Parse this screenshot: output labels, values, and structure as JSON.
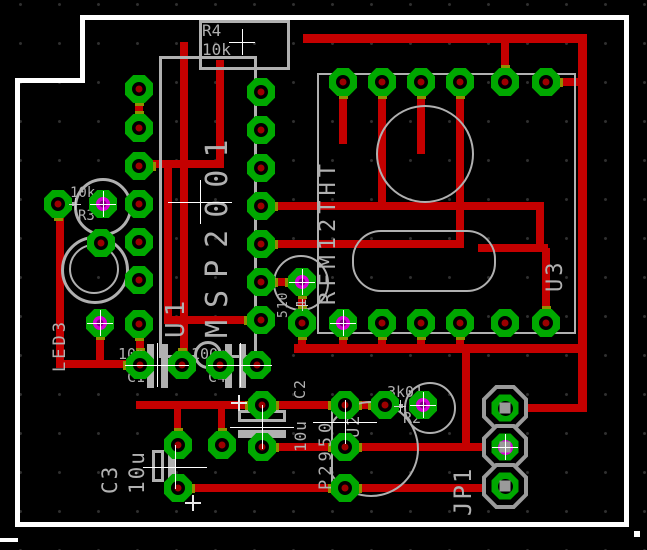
{
  "app": {
    "view": "pcb-layout-canvas",
    "description": "EAGLE-style printed circuit board layout, top copper view"
  },
  "colors": {
    "background": "#000000",
    "trace": "#c40000",
    "pad_ring": "#00a800",
    "pad_hole": "#000000",
    "pad_center": "#9c0000",
    "silkscreen": "#b0b0b0",
    "board_outline": "#ffffff",
    "highlight": "#d800d8",
    "highlight_dark": "#7a007a",
    "pad_trace_overlap": "#8f8f00",
    "grid_dot": "#303030",
    "jp_pad_gray": "#9a9a9a"
  },
  "components": [
    {
      "refdes": "U1",
      "value": "MSP2001",
      "type": "dip-ic"
    },
    {
      "refdes": "U2",
      "value": "P2950",
      "type": "to92-transistor"
    },
    {
      "refdes": "U3",
      "value": "RFM12THT",
      "type": "rf-module"
    },
    {
      "refdes": "R1",
      "value": "510",
      "type": "resistor"
    },
    {
      "refdes": "R2",
      "value": "3k01",
      "type": "resistor"
    },
    {
      "refdes": "R3",
      "value": "10k",
      "type": "resistor"
    },
    {
      "refdes": "R4",
      "value": "10k",
      "type": "resistor"
    },
    {
      "refdes": "C1",
      "value": "10n",
      "type": "capacitor"
    },
    {
      "refdes": "C2",
      "value": "10u",
      "type": "electrolytic-capacitor"
    },
    {
      "refdes": "C3",
      "value": "10u",
      "type": "electrolytic-capacitor"
    },
    {
      "refdes": "C4",
      "value": "100n",
      "type": "capacitor"
    },
    {
      "refdes": "LED3",
      "value": "",
      "type": "led"
    },
    {
      "refdes": "JP1",
      "value": "",
      "type": "pin-header-3"
    }
  ],
  "labels": [
    {
      "text": "R4",
      "x": 202,
      "y": 23,
      "fs": 16,
      "rot": "h",
      "ls": 0
    },
    {
      "text": "10k",
      "x": 202,
      "y": 42,
      "fs": 16,
      "rot": "h",
      "ls": 0
    },
    {
      "text": "10k",
      "x": 70,
      "y": 186,
      "fs": 14,
      "rot": "h",
      "ls": 0
    },
    {
      "text": "R3",
      "x": 78,
      "y": 209,
      "fs": 14,
      "rot": "h",
      "ls": 0
    },
    {
      "text": "10n",
      "x": 118,
      "y": 347,
      "fs": 15,
      "rot": "h",
      "ls": 0
    },
    {
      "text": "C1",
      "x": 127,
      "y": 370,
      "fs": 15,
      "rot": "h",
      "ls": 0
    },
    {
      "text": "100n",
      "x": 191,
      "y": 347,
      "fs": 15,
      "rot": "h",
      "ls": 0
    },
    {
      "text": "C4",
      "x": 208,
      "y": 370,
      "fs": 15,
      "rot": "h",
      "ls": 0
    },
    {
      "text": "3k01",
      "x": 387,
      "y": 385,
      "fs": 15,
      "rot": "h",
      "ls": 0
    },
    {
      "text": "R2",
      "x": 403,
      "y": 411,
      "fs": 15,
      "rot": "h",
      "ls": 0
    },
    {
      "text": "U1",
      "x": 163,
      "y": 338,
      "fs": 26,
      "rot": "v",
      "ls": 6
    },
    {
      "text": "MSP2001",
      "x": 203,
      "y": 338,
      "fs": 30,
      "rot": "v",
      "ls": 12
    },
    {
      "text": "RFM12THT",
      "x": 318,
      "y": 305,
      "fs": 22,
      "rot": "v",
      "ls": 5
    },
    {
      "text": "U3",
      "x": 545,
      "y": 292,
      "fs": 22,
      "rot": "v",
      "ls": 3
    },
    {
      "text": "LED3",
      "x": 52,
      "y": 372,
      "fs": 17,
      "rot": "v",
      "ls": 3
    },
    {
      "text": "510",
      "x": 277,
      "y": 318,
      "fs": 13,
      "rot": "v",
      "ls": 1
    },
    {
      "text": "R1",
      "x": 296,
      "y": 316,
      "fs": 13,
      "rot": "v",
      "ls": 1
    },
    {
      "text": "C2",
      "x": 293,
      "y": 399,
      "fs": 15,
      "rot": "v",
      "ls": 1
    },
    {
      "text": "10u",
      "x": 293,
      "y": 452,
      "fs": 16,
      "rot": "v",
      "ls": 1
    },
    {
      "text": "C3",
      "x": 100,
      "y": 494,
      "fs": 21,
      "rot": "v",
      "ls": 2
    },
    {
      "text": "10u",
      "x": 127,
      "y": 494,
      "fs": 21,
      "rot": "v",
      "ls": 2
    },
    {
      "text": "P2950",
      "x": 318,
      "y": 490,
      "fs": 17,
      "rot": "v",
      "ls": 4
    },
    {
      "text": "U2",
      "x": 346,
      "y": 438,
      "fs": 17,
      "rot": "v",
      "ls": 2
    },
    {
      "text": "JP1",
      "x": 451,
      "y": 516,
      "fs": 24,
      "rot": "v",
      "ls": 2
    }
  ],
  "board_outline": {
    "segments": [
      [
        80,
        15,
        549,
        5
      ],
      [
        624,
        15,
        5,
        512
      ],
      [
        15,
        522,
        614,
        5
      ],
      [
        15,
        78,
        5,
        449
      ],
      [
        15,
        78,
        70,
        5
      ],
      [
        80,
        15,
        5,
        68
      ],
      [
        0,
        538,
        18,
        4
      ],
      [
        634,
        531,
        6,
        6
      ]
    ]
  },
  "traces": [
    [
      303,
      34,
      280,
      9
    ],
    [
      578,
      34,
      9,
      378
    ],
    [
      501,
      38,
      8,
      46
    ],
    [
      546,
      78,
      40,
      8
    ],
    [
      180,
      42,
      8,
      327
    ],
    [
      216,
      60,
      8,
      108
    ],
    [
      136,
      160,
      88,
      8
    ],
    [
      164,
      164,
      8,
      160
    ],
    [
      164,
      316,
      100,
      8
    ],
    [
      339,
      82,
      8,
      62
    ],
    [
      378,
      82,
      8,
      128
    ],
    [
      417,
      82,
      8,
      72
    ],
    [
      456,
      82,
      8,
      166
    ],
    [
      257,
      202,
      287,
      8
    ],
    [
      257,
      240,
      207,
      8
    ],
    [
      536,
      206,
      8,
      46
    ],
    [
      478,
      244,
      70,
      8
    ],
    [
      542,
      248,
      8,
      79
    ],
    [
      257,
      278,
      49,
      8
    ],
    [
      298,
      282,
      8,
      70
    ],
    [
      294,
      344,
      292,
      9
    ],
    [
      339,
      323,
      8,
      29
    ],
    [
      378,
      323,
      8,
      29
    ],
    [
      417,
      323,
      8,
      29
    ],
    [
      456,
      323,
      8,
      29
    ],
    [
      56,
      200,
      8,
      167
    ],
    [
      56,
      360,
      89,
      8
    ],
    [
      96,
      321,
      8,
      47
    ],
    [
      136,
      324,
      8,
      44
    ],
    [
      136,
      401,
      253,
      8
    ],
    [
      218,
      405,
      7,
      42
    ],
    [
      174,
      405,
      7,
      42
    ],
    [
      258,
      443,
      251,
      8
    ],
    [
      174,
      484,
      335,
      8
    ],
    [
      462,
      348,
      8,
      103
    ],
    [
      501,
      404,
      84,
      8
    ],
    [
      135,
      85,
      8,
      46
    ]
  ],
  "pads": [
    {
      "x": 139,
      "y": 89,
      "s": "b",
      "t": "g"
    },
    {
      "x": 139,
      "y": 128,
      "s": "t",
      "t": "g"
    },
    {
      "x": 139,
      "y": 166,
      "s": "r",
      "t": "g"
    },
    {
      "x": 139,
      "y": 204,
      "s": "",
      "t": "g"
    },
    {
      "x": 139,
      "y": 242,
      "s": "",
      "t": "g"
    },
    {
      "x": 139,
      "y": 280,
      "s": "",
      "t": "g"
    },
    {
      "x": 139,
      "y": 324,
      "s": "b",
      "t": "g"
    },
    {
      "x": 58,
      "y": 204,
      "s": "b",
      "t": "g"
    },
    {
      "x": 103,
      "y": 204,
      "s": "",
      "t": "m"
    },
    {
      "x": 101,
      "y": 243,
      "s": "",
      "t": "g"
    },
    {
      "x": 100,
      "y": 323,
      "s": "b",
      "t": "m"
    },
    {
      "x": 261,
      "y": 92,
      "s": "",
      "t": "g"
    },
    {
      "x": 261,
      "y": 130,
      "s": "",
      "t": "g"
    },
    {
      "x": 261,
      "y": 168,
      "s": "",
      "t": "g"
    },
    {
      "x": 261,
      "y": 206,
      "s": "r",
      "t": "g"
    },
    {
      "x": 261,
      "y": 244,
      "s": "r",
      "t": "g"
    },
    {
      "x": 261,
      "y": 282,
      "s": "r",
      "t": "g"
    },
    {
      "x": 261,
      "y": 320,
      "s": "l",
      "t": "g"
    },
    {
      "x": 140,
      "y": 365,
      "s": "lt",
      "t": "g"
    },
    {
      "x": 182,
      "y": 365,
      "s": "t",
      "t": "g"
    },
    {
      "x": 220,
      "y": 365,
      "s": "",
      "t": "g"
    },
    {
      "x": 257,
      "y": 365,
      "s": "",
      "t": "g"
    },
    {
      "x": 222,
      "y": 445,
      "s": "t",
      "t": "g"
    },
    {
      "x": 262,
      "y": 405,
      "s": "lr",
      "t": "g"
    },
    {
      "x": 262,
      "y": 447,
      "s": "r",
      "t": "g"
    },
    {
      "x": 178,
      "y": 445,
      "s": "t",
      "t": "g"
    },
    {
      "x": 178,
      "y": 488,
      "s": "r",
      "t": "g"
    },
    {
      "x": 345,
      "y": 405,
      "s": "lr",
      "t": "g"
    },
    {
      "x": 345,
      "y": 447,
      "s": "lr",
      "t": "g"
    },
    {
      "x": 345,
      "y": 488,
      "s": "lr",
      "t": "g"
    },
    {
      "x": 385,
      "y": 405,
      "s": "l",
      "t": "g"
    },
    {
      "x": 423,
      "y": 405,
      "s": "",
      "t": "m"
    },
    {
      "x": 302,
      "y": 282,
      "s": "lb",
      "t": "m"
    },
    {
      "x": 302,
      "y": 323,
      "s": "tb",
      "t": "g"
    },
    {
      "x": 343,
      "y": 82,
      "s": "b",
      "t": "g"
    },
    {
      "x": 382,
      "y": 82,
      "s": "b",
      "t": "g"
    },
    {
      "x": 421,
      "y": 82,
      "s": "b",
      "t": "g"
    },
    {
      "x": 460,
      "y": 82,
      "s": "b",
      "t": "g"
    },
    {
      "x": 505,
      "y": 82,
      "s": "t",
      "t": "g"
    },
    {
      "x": 546,
      "y": 82,
      "s": "r",
      "t": "g"
    },
    {
      "x": 343,
      "y": 323,
      "s": "b",
      "t": "m"
    },
    {
      "x": 382,
      "y": 323,
      "s": "b",
      "t": "g"
    },
    {
      "x": 421,
      "y": 323,
      "s": "b",
      "t": "g"
    },
    {
      "x": 460,
      "y": 323,
      "s": "b",
      "t": "g"
    },
    {
      "x": 505,
      "y": 323,
      "s": "",
      "t": "g"
    },
    {
      "x": 546,
      "y": 323,
      "s": "t",
      "t": "g"
    },
    {
      "x": 505,
      "y": 408,
      "s": "r",
      "t": "j"
    },
    {
      "x": 505,
      "y": 447,
      "s": "l",
      "t": "jm"
    },
    {
      "x": 505,
      "y": 486,
      "s": "l",
      "t": "j"
    }
  ],
  "silk_shapes": [
    {
      "kind": "rect",
      "x": 199,
      "y": 20,
      "w": 85,
      "h": 44,
      "bw": 3
    },
    {
      "kind": "rect",
      "x": 159,
      "y": 56,
      "w": 92,
      "h": 296,
      "bw": 3
    },
    {
      "kind": "rect",
      "x": 317,
      "y": 73,
      "w": 255,
      "h": 257,
      "bw": 2
    },
    {
      "kind": "circle",
      "cx": 423,
      "cy": 152,
      "r": 47,
      "bw": 2
    },
    {
      "kind": "circle",
      "cx": 100,
      "cy": 204,
      "r": 26,
      "bw": 3
    },
    {
      "kind": "circle",
      "cx": 92,
      "cy": 267,
      "r": 31,
      "bw": 3
    },
    {
      "kind": "circle",
      "cx": 92,
      "cy": 267,
      "r": 23,
      "bw": 2
    },
    {
      "kind": "circle",
      "cx": 299,
      "cy": 281,
      "r": 26,
      "bw": 2
    },
    {
      "kind": "circle",
      "cx": 428,
      "cy": 406,
      "r": 24,
      "bw": 2
    },
    {
      "kind": "stadium",
      "x": 352,
      "y": 230,
      "w": 140,
      "h": 58,
      "bw": 2
    },
    {
      "kind": "u2circle",
      "cx": 369,
      "cy": 447,
      "r": 46,
      "chord": 331,
      "bw": 2
    },
    {
      "kind": "line",
      "x": 58,
      "y": 202,
      "w": 18,
      "h": 4
    },
    {
      "kind": "line",
      "x": 389,
      "y": 404,
      "w": 14,
      "h": 4
    },
    {
      "kind": "notch",
      "cx": 205,
      "cy": 352,
      "r": 11
    },
    {
      "kind": "bar",
      "x": 147,
      "y": 344,
      "w": 7,
      "h": 44
    },
    {
      "kind": "bar",
      "x": 161,
      "y": 344,
      "w": 7,
      "h": 44
    },
    {
      "kind": "bar",
      "x": 225,
      "y": 344,
      "w": 7,
      "h": 44
    },
    {
      "kind": "bar",
      "x": 239,
      "y": 344,
      "w": 7,
      "h": 44
    },
    {
      "kind": "hbar",
      "x": 238,
      "y": 410,
      "w": 48,
      "h": 12
    },
    {
      "kind": "bar",
      "x": 238,
      "y": 430,
      "w": 48,
      "h": 8
    },
    {
      "kind": "hbar",
      "x": 152,
      "y": 450,
      "w": 12,
      "h": 32
    },
    {
      "kind": "bar",
      "x": 168,
      "y": 450,
      "w": 7,
      "h": 32
    },
    {
      "kind": "plus",
      "x": 239,
      "y": 403
    },
    {
      "kind": "plus",
      "x": 193,
      "y": 503
    }
  ],
  "crosshairs": [
    {
      "x": 242,
      "y": 42,
      "t": "w"
    },
    {
      "x": 200,
      "y": 202,
      "t": "W"
    },
    {
      "x": 103,
      "y": 204,
      "t": "w"
    },
    {
      "x": 75,
      "y": 204,
      "t": "s"
    },
    {
      "x": 100,
      "y": 323,
      "t": "w"
    },
    {
      "x": 157,
      "y": 365,
      "t": "W"
    },
    {
      "x": 240,
      "y": 365,
      "t": "W"
    },
    {
      "x": 262,
      "y": 427,
      "t": "W"
    },
    {
      "x": 175,
      "y": 467,
      "t": "W"
    },
    {
      "x": 345,
      "y": 422,
      "t": "W"
    },
    {
      "x": 302,
      "y": 282,
      "t": "w"
    },
    {
      "x": 302,
      "y": 305,
      "t": "s"
    },
    {
      "x": 400,
      "y": 406,
      "t": "s"
    },
    {
      "x": 423,
      "y": 405,
      "t": "w"
    },
    {
      "x": 343,
      "y": 323,
      "t": "w"
    },
    {
      "x": 505,
      "y": 447,
      "t": "w"
    }
  ]
}
